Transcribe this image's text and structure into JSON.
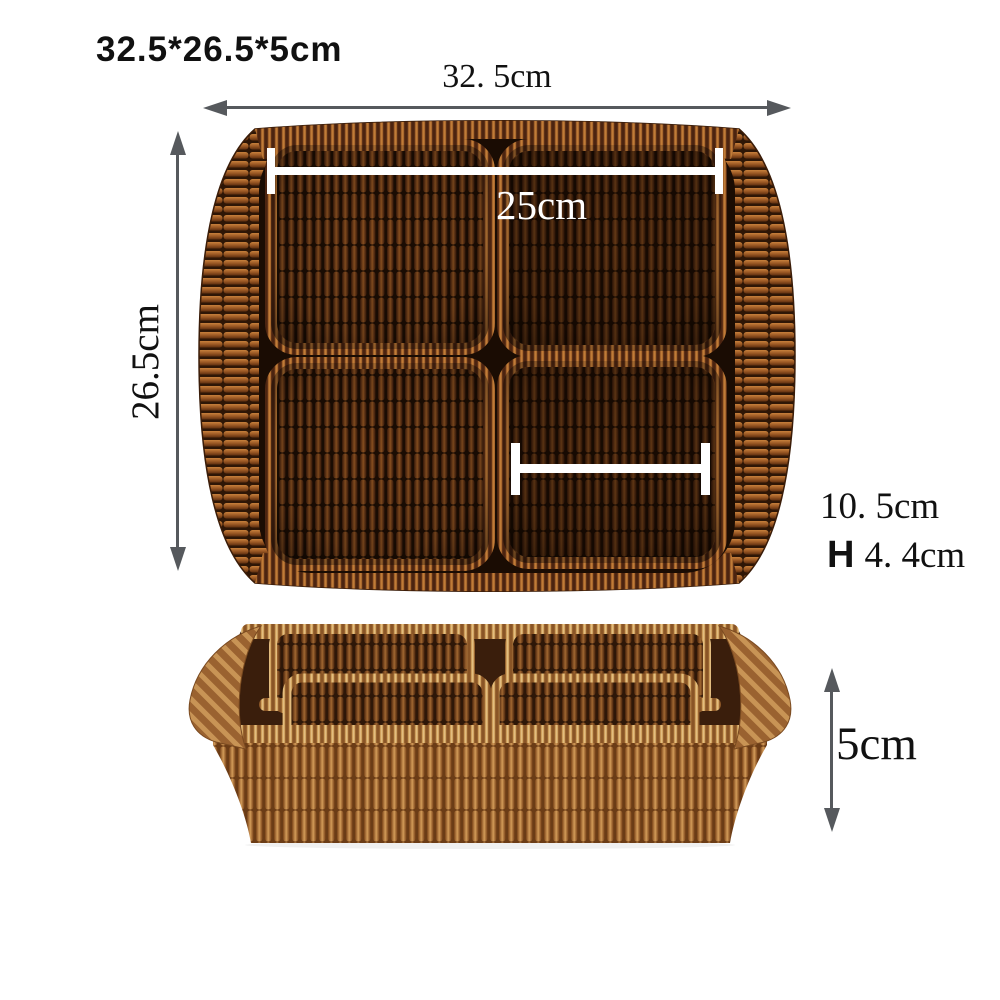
{
  "title": "32.5*26.5*5cm",
  "dimensions": {
    "outer_width": "32. 5cm",
    "outer_depth": "26.5cm",
    "inner_width": "25cm",
    "compartment_width": "10. 5cm",
    "height_prefix": "H",
    "compartment_height": "4. 4cm",
    "tray_height": "5cm"
  },
  "colors": {
    "background": "#ffffff",
    "arrow": "#56595d",
    "dim_line": "#ffffff",
    "text": "#111111",
    "wicker_dark": "#6b3a16",
    "wicker_light": "#b57a3f"
  }
}
